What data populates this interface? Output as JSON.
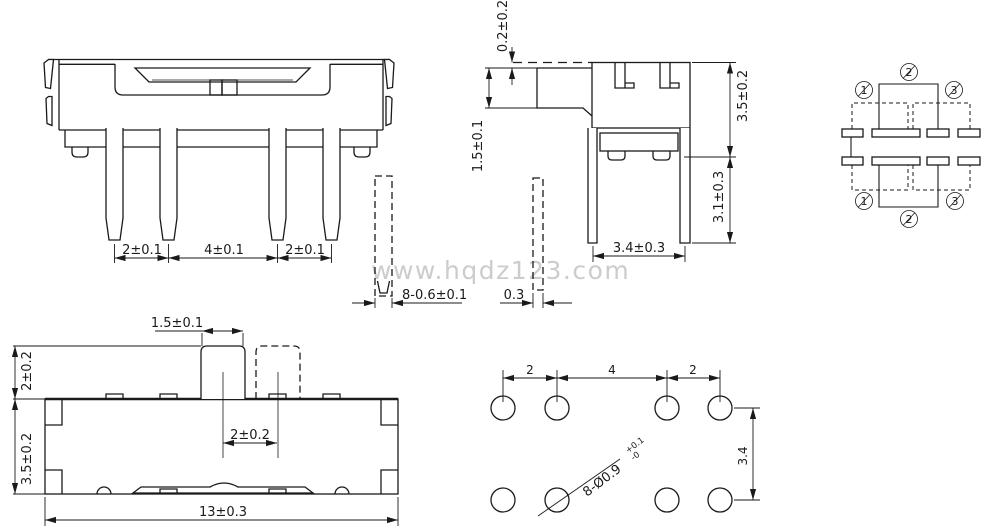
{
  "watermark": "www.hqdz123.com",
  "colors": {
    "line": "#1a1a1a",
    "watermark": "#cccccc",
    "background": "#ffffff"
  },
  "front_view": {
    "pin_pitch_left": "2±0.1",
    "pin_pitch_middle": "4±0.1",
    "pin_pitch_right": "2±0.1"
  },
  "pin_sections": {
    "pin_width": "8-0.6±0.1",
    "pin_thickness": "0.3"
  },
  "side_view": {
    "knob_protrusion": "0.2±0.2",
    "knob_height": "1.5±0.1",
    "body_height": "3.5±0.2",
    "pin_length": "3.1±0.3",
    "leg_span": "3.4±0.3"
  },
  "schematic": {
    "pin1": "1",
    "pin2": "2",
    "pin3": "3"
  },
  "top_view": {
    "knob_width": "1.5±0.1",
    "knob_protrusion": "2±0.2",
    "body_depth": "3.5±0.2",
    "travel": "2±0.2",
    "body_length": "13±0.3"
  },
  "pcb_view": {
    "pitch_left": "2",
    "pitch_middle": "4",
    "pitch_right": "2",
    "row_span": "3.4",
    "hole_spec": "8-Ø0.9",
    "hole_tol_upper": "+0.1",
    "hole_tol_lower": "-0"
  }
}
